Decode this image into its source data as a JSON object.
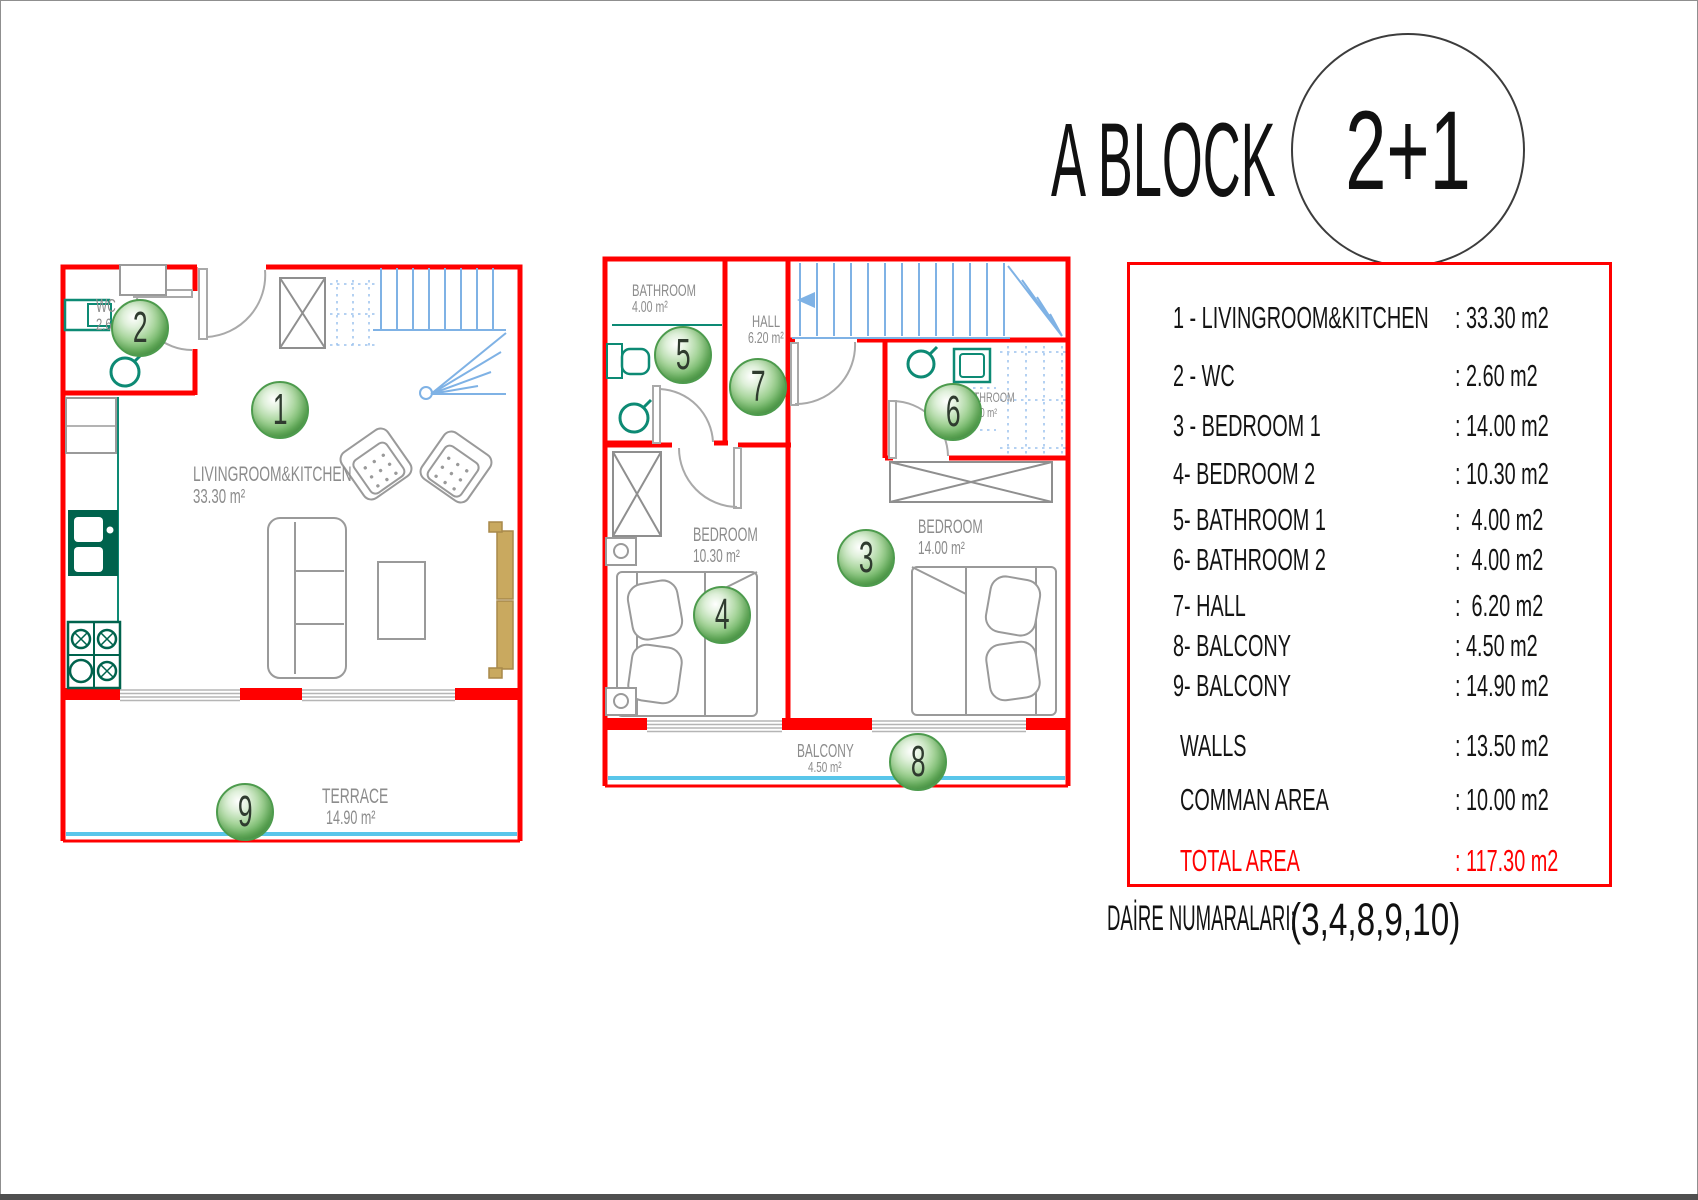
{
  "title": {
    "block": "A BLOCK",
    "unit": "2+1"
  },
  "plans": {
    "lower": {
      "rooms": {
        "living": {
          "badge": "1",
          "name": "LIVINGROOM&KITCHEN",
          "area": "33.30 m²"
        },
        "wc": {
          "badge": "2",
          "name": "WC",
          "area": "2.60 m²"
        },
        "terrace": {
          "badge": "9",
          "name": "TERRACE",
          "area": "14.90 m²"
        }
      }
    },
    "upper": {
      "rooms": {
        "bathroom1": {
          "badge": "5",
          "name": "BATHROOM",
          "area": "4.00 m²"
        },
        "hall": {
          "badge": "7",
          "name": "HALL",
          "area": "6.20 m²"
        },
        "bathroom2": {
          "badge": "6",
          "name": "BATHROOM",
          "area": "4.00 m²"
        },
        "bedroom2": {
          "badge": "4",
          "name": "BEDROOM",
          "area": "10.30 m²"
        },
        "bedroom1": {
          "badge": "3",
          "name": "BEDROOM",
          "area": "14.00 m²"
        },
        "balcony": {
          "badge": "8",
          "name": "BALCONY",
          "area": "4.50 m²"
        }
      }
    }
  },
  "legend": {
    "rows": [
      {
        "label": "1 - LIVINGROOM&KITCHEN",
        "value": ": 33.30 m2"
      },
      {
        "label": "2 - WC",
        "value": ": 2.60 m2"
      },
      {
        "label": "3 - BEDROOM 1",
        "value": ": 14.00 m2"
      },
      {
        "label": "4- BEDROOM 2",
        "value": ": 10.30 m2"
      },
      {
        "label": "5- BATHROOM 1",
        "value": ":  4.00 m2"
      },
      {
        "label": "6- BATHROOM 2",
        "value": ":  4.00 m2"
      },
      {
        "label": "7- HALL",
        "value": ":  6.20 m2"
      },
      {
        "label": "8- BALCONY",
        "value": ": 4.50 m2"
      },
      {
        "label": "9- BALCONY",
        "value": ": 14.90 m2"
      },
      {
        "label": "WALLS",
        "value": ": 13.50 m2"
      },
      {
        "label": "COMMAN AREA",
        "value": ": 10.00 m2"
      }
    ],
    "total": {
      "label": "TOTAL AREA",
      "value": ": 117.30 m2"
    }
  },
  "footer": {
    "label": "DAİRE NUMARALARI:",
    "numbers": "(3,4,8,9,10)"
  },
  "colors": {
    "wall": "#ff0000",
    "stairs": "#7fb2e5",
    "fixture": "#0d8a74",
    "kitchen": "#00634d",
    "glass": "#59c6ea",
    "badge_green": "#4e9e4e",
    "furniture": "#9a9a9a",
    "total_red": "#ff0000"
  }
}
